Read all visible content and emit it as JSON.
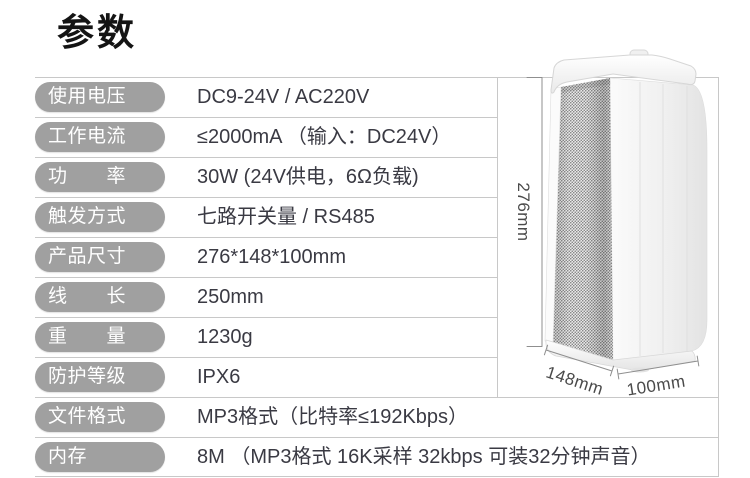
{
  "title": "参数",
  "table": {
    "rows": [
      {
        "label": "使用电压",
        "value": "DC9-24V / AC220V"
      },
      {
        "label": "工作电流",
        "value": "≤2000mA （输入：DC24V）"
      },
      {
        "label": "功　　率",
        "value": "30W (24V供电，6Ω负载)"
      },
      {
        "label": "触发方式",
        "value": "七路开关量 / RS485"
      },
      {
        "label": "产品尺寸",
        "value": "276*148*100mm"
      },
      {
        "label": "线　　长",
        "value": "250mm"
      },
      {
        "label": "重　　量",
        "value": "1230g"
      },
      {
        "label": "防护等级",
        "value": "IPX6"
      },
      {
        "label": "文件格式",
        "value": "MP3格式（比特率≤192Kbps）"
      },
      {
        "label": "内存",
        "value": "8M （MP3格式 16K采样 32kbps 可装32分钟声音）"
      }
    ]
  },
  "product_image": {
    "description": "white-column-speaker",
    "dimensions": {
      "height": "276mm",
      "depth": "148mm",
      "width": "100mm"
    }
  },
  "colors": {
    "pill_background": "#a0a0a0",
    "pill_text": "#ffffff",
    "value_text": "#3a3a43",
    "table_border": "#c8c8c8",
    "dimension_annotation": "#4a4a4a",
    "title": "#141414"
  }
}
